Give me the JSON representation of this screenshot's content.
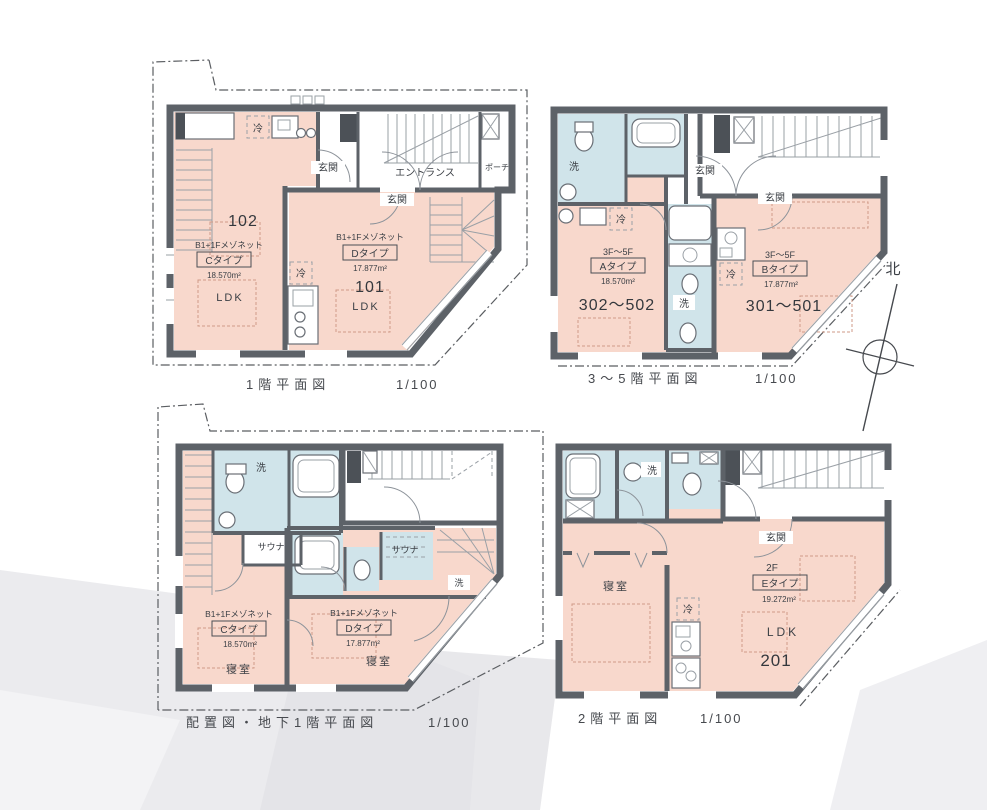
{
  "colors": {
    "room_pink": "#f8d8cc",
    "wet_blue": "#d0e4ea",
    "wall_gray": "#5d6268",
    "line_gray": "#9aa0a6",
    "text_gray": "#3c4046"
  },
  "compass": {
    "north": "北"
  },
  "plans": {
    "f1": {
      "caption": "1階平面図",
      "scale": "1/100",
      "genkan_left": "玄関",
      "genkan_right": "玄関",
      "entrance": "エントランス",
      "porch": "ポーチ",
      "unit_c": {
        "number": "102",
        "mezzonet": "B1+1Fメゾネット",
        "type": "Cタイプ",
        "area": "18.570m²",
        "room": "LDK",
        "fridge": "冷"
      },
      "unit_d": {
        "number": "101",
        "mezzonet": "B1+1Fメゾネット",
        "type": "Dタイプ",
        "area": "17.877m²",
        "room": "LDK",
        "fridge": "冷"
      }
    },
    "f35": {
      "caption": "3〜5階平面図",
      "scale": "1/100",
      "genkan_left": "玄関",
      "genkan_right": "玄関",
      "unit_a": {
        "numbers": "302〜502",
        "floors": "3F〜5F",
        "type": "Aタイプ",
        "area": "18.570m²",
        "wash": "洗",
        "fridge": "冷"
      },
      "unit_b": {
        "numbers": "301〜501",
        "floors": "3F〜5F",
        "type": "Bタイプ",
        "area": "17.877m²",
        "wash": "洗",
        "fridge": "冷"
      }
    },
    "b1": {
      "caption": "配置図・地下1階平面図",
      "scale": "1/100",
      "unit_c": {
        "mezzonet": "B1+1Fメゾネット",
        "type": "Cタイプ",
        "area": "18.570m²",
        "room": "寝室",
        "sauna": "サウナ",
        "wash": "洗"
      },
      "unit_d": {
        "mezzonet": "B1+1Fメゾネット",
        "type": "Dタイプ",
        "area": "17.877m²",
        "room": "寝室",
        "sauna": "サウナ",
        "wash": "洗"
      }
    },
    "f2": {
      "caption": "2階平面図",
      "scale": "1/100",
      "genkan": "玄関",
      "unit_e": {
        "number": "201",
        "floor": "2F",
        "type": "Eタイプ",
        "area": "19.272m²",
        "room_ldk": "LDK",
        "room_bed": "寝室",
        "wash": "洗",
        "fridge": "冷"
      }
    }
  }
}
